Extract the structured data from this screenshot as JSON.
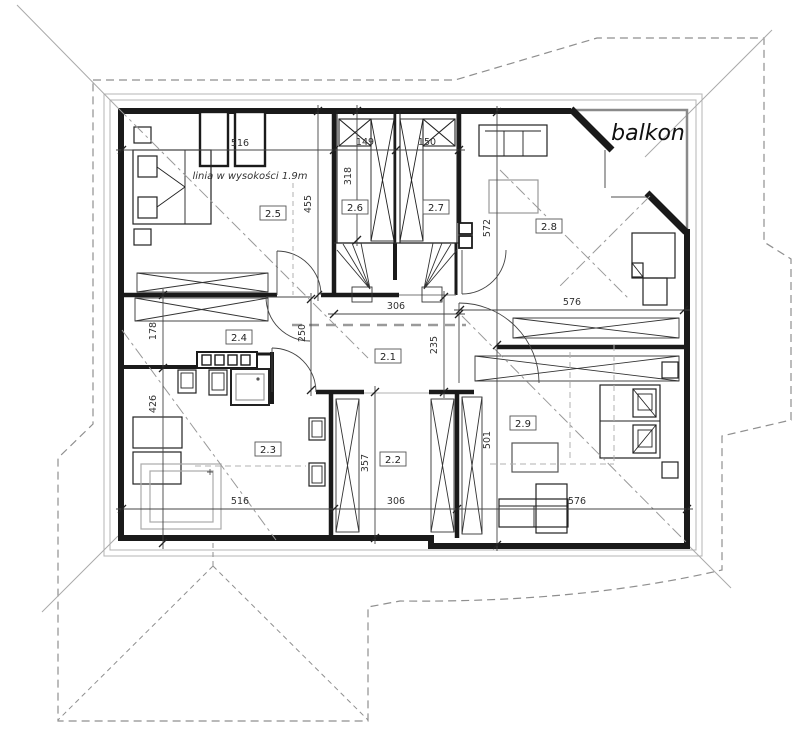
{
  "labels": {
    "balkon": "balkon",
    "height_line": "linia w wysokości 1.9m"
  },
  "rooms": {
    "r21": "2.1",
    "r22": "2.2",
    "r23": "2.3",
    "r24": "2.4",
    "r25": "2.5",
    "r26": "2.6",
    "r27": "2.7",
    "r28": "2.8",
    "r29": "2.9"
  },
  "dims": {
    "d516_top": "516",
    "d149": "149",
    "d150": "150",
    "d318": "318",
    "d455": "455",
    "d572": "572",
    "d576_right": "576",
    "d178": "178",
    "d426": "426",
    "d250": "250",
    "d306_stairs": "306",
    "d235": "235",
    "d357": "357",
    "d306_bottom": "306",
    "d501": "501",
    "d576_bottom": "576",
    "d516_bottom": "516"
  },
  "colors": {
    "wall": "#1a1a1a",
    "roof_dash": "#8f8f8f",
    "dim_line": "#444444",
    "furniture": "#222222",
    "gray_item": "#999999"
  }
}
